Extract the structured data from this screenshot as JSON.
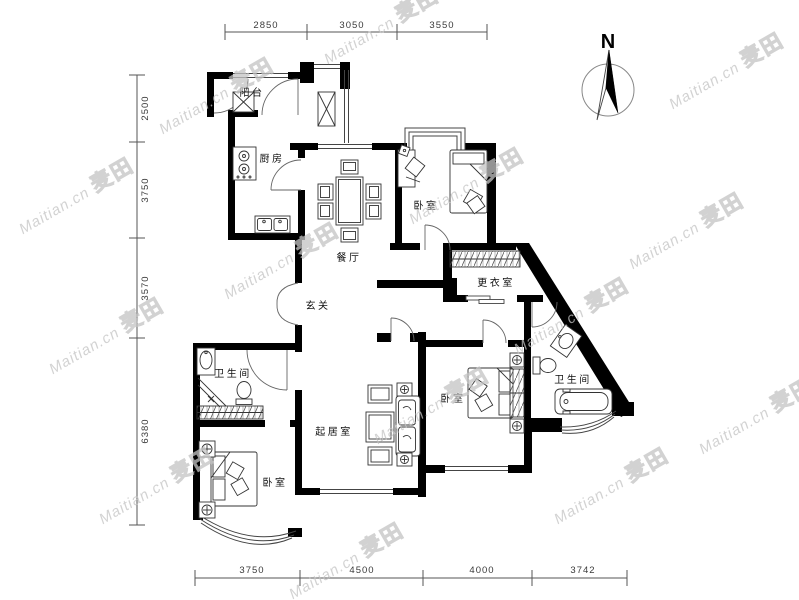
{
  "watermark": {
    "text": "Maitian.cn",
    "logo": "麦田"
  },
  "compass": {
    "label": "N"
  },
  "dimensions": {
    "top": [
      "2850",
      "3050",
      "3550"
    ],
    "left": [
      "2500",
      "3750",
      "3570",
      "6380"
    ],
    "bottom": [
      "3750",
      "4500",
      "4000",
      "3742"
    ]
  },
  "rooms": {
    "balcony": "阳台",
    "kitchen": "厨房",
    "dining": "餐厅",
    "bedroom_top": "卧室",
    "dressing": "更衣室",
    "foyer": "玄关",
    "bath_left": "卫生间",
    "bath_right": "卫生间",
    "living": "起居室",
    "bedroom_right": "卧室",
    "bedroom_bottom": "卧室"
  },
  "colors": {
    "wall": "#000000",
    "thin_line": "#444444",
    "dim_text": "#3a3a3a",
    "watermark": "#c4c4c4"
  }
}
